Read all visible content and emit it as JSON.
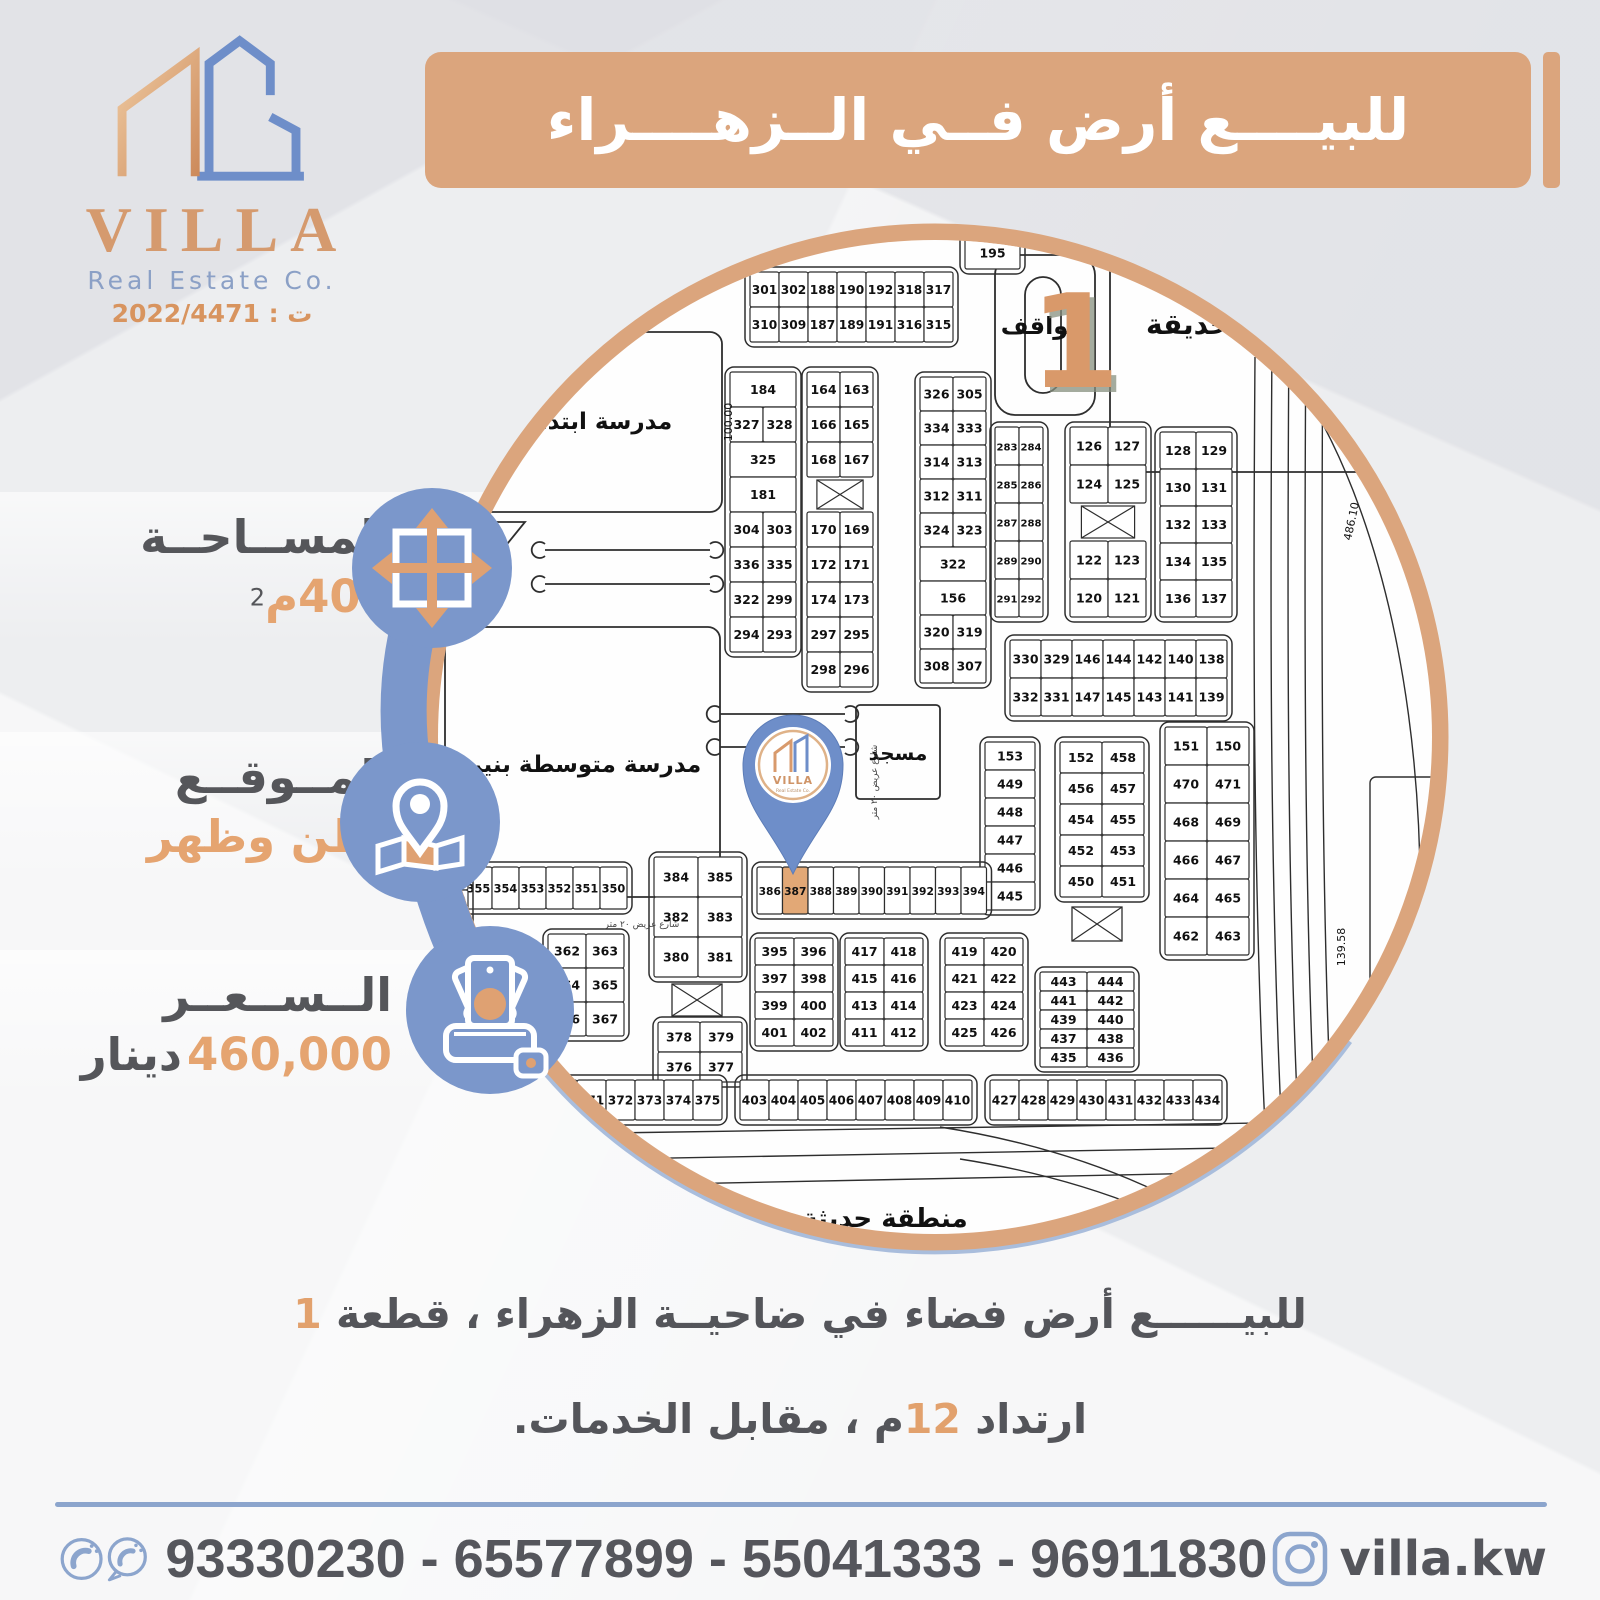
{
  "colors": {
    "accent_orange": "#dba57d",
    "accent_blue": "#7b97cb",
    "pin_blue": "#6e8ec9",
    "text_gray": "#55565a",
    "text_orange": "#e5a470",
    "highlight": "#e2a876",
    "map_line": "#2e2e2e",
    "footer_blue": "#8ca5cd"
  },
  "brand": {
    "name": "VILLA",
    "tagline": "Real Estate Co.",
    "license_label": "ت : 2022/4471"
  },
  "title": {
    "text": "للبيــــع أرض فــي الــزهــــراء"
  },
  "info": [
    {
      "label": "المســاحــة",
      "value": "400م",
      "sup": "2",
      "icon": "expand-arrows-icon"
    },
    {
      "label": "المــوقــع",
      "value": "بطن وظهر",
      "icon": "map-pin-icon"
    },
    {
      "label": "الــســعــر",
      "value": "460,000",
      "unit": "دينار",
      "icon": "money-icon"
    }
  ],
  "description": {
    "line1_pre": "للبيــــــع أرض فضاء في ضاحيــة الزهراء ، قطعة ",
    "line1_num": "1",
    "line2_pre": "ارتداد ",
    "line2_num": "12",
    "line2_post": "م ، مقابل الخدمات."
  },
  "footer": {
    "phones": "93330230 - 65577899 - 55041333 - 96911830",
    "instagram": "villa.kw"
  },
  "map": {
    "labels": {
      "park": "حديقة",
      "parking": "مواقف",
      "block_number": "1",
      "school_primary": "مدرسة ابتدائية",
      "school_middle": "مدرسة متوسطة بنين",
      "mosque": "مسجد",
      "clipped_bottom": "منطقة حديثة",
      "dim_school": "100.00",
      "dim_right": "486.10",
      "dim_right2": "139.58",
      "street": "شارع عريض ٢٠ متر"
    },
    "highlighted_plot": "387",
    "plot_groups": [
      {
        "x": 330,
        "y": 50,
        "cw": 29,
        "ch": 35,
        "rows": [
          [
            "301",
            "302",
            "188",
            "190",
            "192",
            "318",
            "317"
          ],
          [
            "310",
            "309",
            "187",
            "189",
            "191",
            "316",
            "315"
          ]
        ]
      },
      {
        "x": 545,
        "y": 15,
        "cw": 55,
        "ch": 32,
        "rows": [
          [
            "195"
          ]
        ]
      },
      {
        "x": 310,
        "y": 150,
        "cw": 33,
        "ch": 35,
        "rows": [
          [
            "184"
          ],
          [
            "327",
            "328"
          ],
          [
            "325"
          ],
          [
            "181"
          ],
          [
            "304",
            "303"
          ],
          [
            "336",
            "335"
          ],
          [
            "322",
            "299"
          ],
          [
            "294",
            "293"
          ]
        ]
      },
      {
        "x": 387,
        "y": 150,
        "cw": 33,
        "ch": 35,
        "rows": [
          [
            "164",
            "163"
          ],
          [
            "166",
            "165"
          ],
          [
            "168",
            "167"
          ],
          [
            "#"
          ],
          [
            "170",
            "169"
          ],
          [
            "172",
            "171"
          ],
          [
            "174",
            "173"
          ],
          [
            "297",
            "295"
          ],
          [
            "298",
            "296"
          ]
        ]
      },
      {
        "x": 500,
        "y": 155,
        "cw": 33,
        "ch": 34,
        "rows": [
          [
            "326",
            "305"
          ],
          [
            "334",
            "333"
          ],
          [
            "314",
            "313"
          ],
          [
            "312",
            "311"
          ],
          [
            "324",
            "323"
          ],
          [
            "322"
          ],
          [
            "156"
          ],
          [
            "320",
            "319"
          ],
          [
            "308",
            "307"
          ]
        ]
      },
      {
        "x": 575,
        "y": 205,
        "cw": 24,
        "ch": 38,
        "rows": [
          [
            "283",
            "284"
          ],
          [
            "285",
            "286"
          ],
          [
            "287",
            "288"
          ],
          [
            "289",
            "290"
          ],
          [
            "291",
            "292"
          ]
        ]
      },
      {
        "x": 650,
        "y": 205,
        "cw": 38,
        "ch": 38,
        "rows": [
          [
            "126",
            "127"
          ],
          [
            "124",
            "125"
          ],
          [
            "#"
          ],
          [
            "122",
            "123"
          ],
          [
            "120",
            "121"
          ]
        ]
      },
      {
        "x": 740,
        "y": 210,
        "cw": 36,
        "ch": 37,
        "rows": [
          [
            "128",
            "129"
          ],
          [
            "130",
            "131"
          ],
          [
            "132",
            "133"
          ],
          [
            "134",
            "135"
          ],
          [
            "136",
            "137"
          ]
        ]
      },
      {
        "x": 590,
        "y": 418,
        "cw": 31,
        "ch": 38,
        "rows": [
          [
            "330",
            "329",
            "146",
            "144",
            "142",
            "140",
            "138"
          ],
          [
            "332",
            "331",
            "147",
            "145",
            "143",
            "141",
            "139"
          ]
        ]
      },
      {
        "x": 565,
        "y": 520,
        "cw": 50,
        "ch": 28,
        "rows": [
          [
            "153"
          ],
          [
            "449"
          ],
          [
            "448"
          ],
          [
            "447"
          ],
          [
            "446"
          ],
          [
            "445"
          ]
        ]
      },
      {
        "x": 640,
        "y": 520,
        "cw": 42,
        "ch": 31,
        "rows": [
          [
            "152",
            "458"
          ],
          [
            "456",
            "457"
          ],
          [
            "454",
            "455"
          ],
          [
            "452",
            "453"
          ],
          [
            "450",
            "451"
          ]
        ]
      },
      {
        "x": 745,
        "y": 505,
        "cw": 42,
        "ch": 38,
        "rows": [
          [
            "151",
            "150"
          ],
          [
            "470",
            "471"
          ],
          [
            "468",
            "469"
          ],
          [
            "466",
            "467"
          ],
          [
            "464",
            "465"
          ],
          [
            "462",
            "463"
          ]
        ]
      },
      {
        "x": 337,
        "y": 645,
        "cw": 25.5,
        "ch": 47,
        "rows": [
          [
            "386",
            "387",
            "388",
            "389",
            "390",
            "391",
            "392",
            "393",
            "394"
          ]
        ]
      },
      {
        "x": 45,
        "y": 645,
        "cw": 27,
        "ch": 42,
        "rows": [
          [
            "355",
            "354",
            "353",
            "352",
            "351",
            "350"
          ]
        ]
      },
      {
        "x": 8,
        "y": 548,
        "cw": 40,
        "ch": 40,
        "rows": [
          [
            "385"
          ],
          [
            "383"
          ],
          [
            "381"
          ],
          [
            "379"
          ]
        ]
      },
      {
        "x": 234,
        "y": 635,
        "cw": 44,
        "ch": 40,
        "rows": [
          [
            "384",
            "385"
          ],
          [
            "382",
            "383"
          ],
          [
            "380",
            "381"
          ]
        ]
      },
      {
        "x": 238,
        "y": 800,
        "cw": 42,
        "ch": 30,
        "rows": [
          [
            "378",
            "379"
          ],
          [
            "376",
            "377"
          ]
        ]
      },
      {
        "x": 128,
        "y": 712,
        "cw": 38,
        "ch": 34,
        "rows": [
          [
            "362",
            "363"
          ],
          [
            "364",
            "365"
          ],
          [
            "366",
            "367"
          ]
        ]
      },
      {
        "x": 335,
        "y": 716,
        "cw": 39,
        "ch": 27,
        "rows": [
          [
            "395",
            "396"
          ],
          [
            "397",
            "398"
          ],
          [
            "399",
            "400"
          ],
          [
            "401",
            "402"
          ]
        ]
      },
      {
        "x": 425,
        "y": 716,
        "cw": 39,
        "ch": 27,
        "rows": [
          [
            "417",
            "418"
          ],
          [
            "415",
            "416"
          ],
          [
            "413",
            "414"
          ],
          [
            "411",
            "412"
          ]
        ]
      },
      {
        "x": 525,
        "y": 716,
        "cw": 39,
        "ch": 27,
        "rows": [
          [
            "419",
            "420"
          ],
          [
            "421",
            "422"
          ],
          [
            "423",
            "424"
          ],
          [
            "425",
            "426"
          ]
        ]
      },
      {
        "x": 620,
        "y": 750,
        "cw": 47,
        "ch": 19,
        "rows": [
          [
            "443",
            "444"
          ],
          [
            "441",
            "442"
          ],
          [
            "439",
            "440"
          ],
          [
            "437",
            "438"
          ],
          [
            "435",
            "436"
          ]
        ]
      },
      {
        "x": 128,
        "y": 858,
        "cw": 29,
        "ch": 40,
        "rows": [
          [
            "370",
            "371",
            "372",
            "373",
            "374",
            "375"
          ]
        ]
      },
      {
        "x": 320,
        "y": 858,
        "cw": 29,
        "ch": 40,
        "rows": [
          [
            "403",
            "404",
            "405",
            "406",
            "407",
            "408",
            "409",
            "410"
          ]
        ]
      },
      {
        "x": 570,
        "y": 858,
        "cw": 29,
        "ch": 40,
        "rows": [
          [
            "427",
            "428",
            "429",
            "430",
            "431",
            "432",
            "433",
            "434"
          ]
        ]
      }
    ],
    "utility_boxes": [
      {
        "x": 252,
        "y": 762,
        "w": 50,
        "h": 32
      },
      {
        "x": 652,
        "y": 685,
        "w": 50,
        "h": 34
      }
    ]
  }
}
